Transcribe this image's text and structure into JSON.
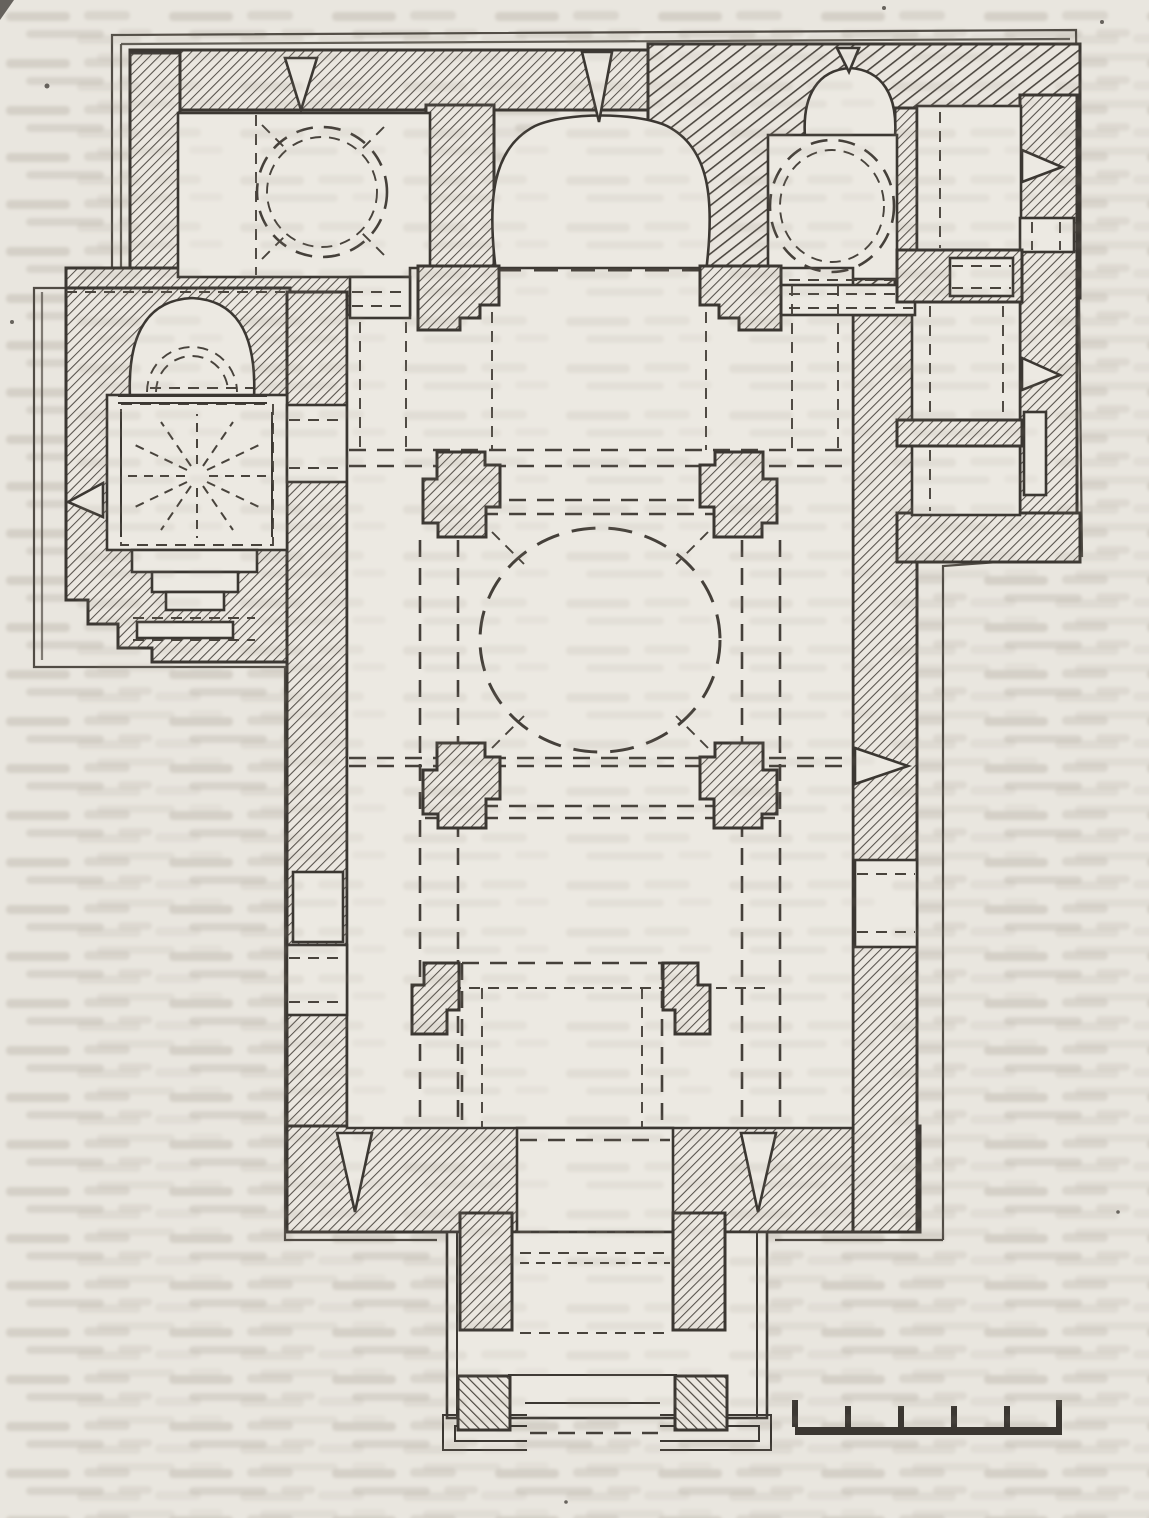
{
  "page": {
    "kind": "scanned book page",
    "paper_color": "#e9e6df",
    "ink_color": "#3b3732",
    "visible_text": [],
    "texture": "illegible mirrored text bleed-through from reverse side of the page"
  },
  "figure": {
    "kind": "architectural floor plan",
    "subject": "domed church: central naos with dome on four stepped crossing piers, three apses along the top wall, domed corner room at top-left, side chapel with radially-vaulted square chamber and horseshoe apse at left, row of annex rooms at right, entrance porch on two piers at bottom",
    "conventions": {
      "walls": "diagonal hatching",
      "overhead_vaults_and_arches": "dashed lines",
      "domes": "dashed circles and ovals",
      "windows": "splayed wedge-shaped wall openings"
    },
    "window_count": 7,
    "crossing_pier_count": 4,
    "porch_pier_count": 2
  },
  "scale_bar": {
    "ticks": 6,
    "segments": 5,
    "labels": []
  },
  "colors": {
    "paper": "#e9e6df",
    "room_fill": "#ece9e2",
    "hatch_fine": "#55504a",
    "hatch_coarse": "#4d4841",
    "outline": "#3b3732",
    "dashes": "#45403a",
    "bleed_text": "#978f82"
  }
}
